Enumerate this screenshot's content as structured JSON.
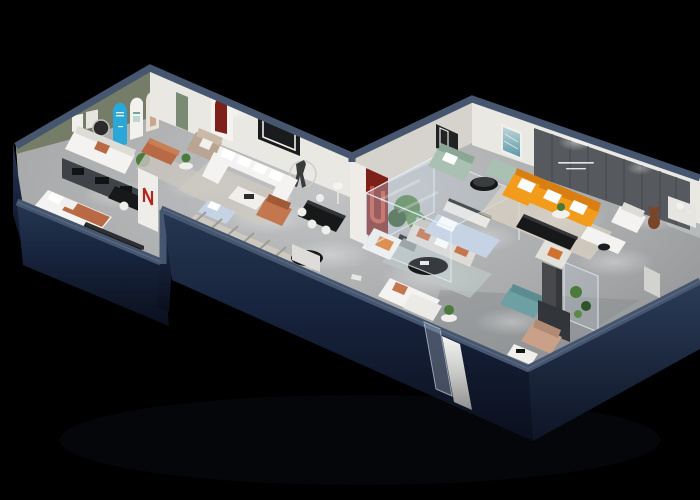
{
  "scene": {
    "type": "3d-isometric-interior-render",
    "description": "Dollhouse cutaway aerial view of a furniture showroom apartment with dark navy exterior walls on a black background",
    "view": "isometric-from-above",
    "legible_text_present": false,
    "feature_wall": {
      "has_small_slogan_text": true,
      "slogan_legible": false
    }
  },
  "palette": {
    "bg": "#000000",
    "wall_cap": "#46566f",
    "wall_cap_light": "#5d6d8a",
    "navy_face": "#1b2740",
    "navy_face_dark": "#0d1322",
    "floor": "#a8aaab",
    "floor_dark": "#96989a",
    "floor_light": "#cfd0d0",
    "inner_wall": "#eae8e3",
    "inner_wall_shade": "#d6d3cd",
    "olive_wall": "#757d68",
    "feature_wall": "#56595d",
    "feature_panel_line": "#474a4e",
    "charcoal_unit": "#3f4246",
    "black_furniture": "#17181a",
    "white_furniture": "#f4f3f1",
    "orange_sofa": "#f39c1c",
    "orange_sofa_shade": "#d97f12",
    "terracotta": "#b96a45",
    "rust_pillow": "#c4764f",
    "sage": "#a9c0b2",
    "sage_dark": "#8aa695",
    "teal_bench": "#6d9fa3",
    "cyan_poster": "#2aa7d6",
    "dark_red": "#7c2019",
    "maroon_arch": "#8e2b1e",
    "tan_leather": "#c9a188",
    "taupe_sofa": "#b9a593",
    "bed_blue": "#c6d3e4",
    "glass_tint": "#cfe0ec",
    "plant_green": "#4a7a3c",
    "plant_dark": "#2f5429",
    "rug": "#cdc9c1",
    "rug_stripe": "#a09c92",
    "rug_pale_blue": "#bdc9c6",
    "bear_brown": "#7a4526",
    "green_door": "#7b8a75"
  },
  "rooms": [
    {
      "id": "bedroom-display",
      "label": "Bedroom display alcove"
    },
    {
      "id": "green-wall-lounge",
      "label": "Olive-wall lounge"
    },
    {
      "id": "arch-gallery-hall",
      "label": "Arched gallery hall"
    },
    {
      "id": "white-sectional-room",
      "label": "White sectional living room"
    },
    {
      "id": "dining-area",
      "label": "Dining display"
    },
    {
      "id": "corridor",
      "label": "Central corridor"
    },
    {
      "id": "glass-bedroom",
      "label": "Glass-box bedroom display"
    },
    {
      "id": "sage-lounge",
      "label": "Sage sofa lounge"
    },
    {
      "id": "orange-sofa-room",
      "label": "Orange sectional living room"
    },
    {
      "id": "sleep-bath-displays",
      "label": "Sleep and bath displays"
    },
    {
      "id": "entrance",
      "label": "Entrance"
    }
  ]
}
